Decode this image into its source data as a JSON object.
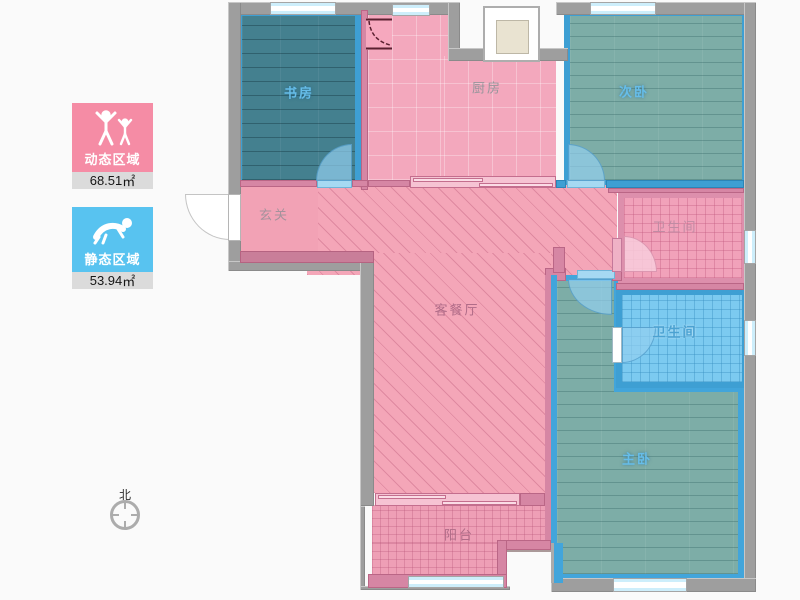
{
  "legend": {
    "dynamic": {
      "label": "动态区域",
      "value": "68.51",
      "unit": "㎡",
      "color": "#F58CA5"
    },
    "static": {
      "label": "静态区域",
      "value": "53.94",
      "unit": "㎡",
      "color": "#58C3F0"
    }
  },
  "compass": {
    "north_label": "北"
  },
  "rooms": {
    "study": {
      "label": "书房"
    },
    "kitchen": {
      "label": "厨房"
    },
    "second_bedroom": {
      "label": "次卧"
    },
    "hallway": {
      "label": "玄关"
    },
    "living_dining": {
      "label": "客餐厅"
    },
    "bathroom_1": {
      "label": "卫生间"
    },
    "bathroom_2": {
      "label": "卫生间"
    },
    "master_bedroom": {
      "label": "主卧"
    },
    "balcony": {
      "label": "阳台"
    }
  },
  "colors": {
    "dynamic_area": "#F58CA5",
    "static_area": "#58C3F0",
    "wall_gray": "#9E9E9E",
    "wall_pink": "#D686A4",
    "wall_blue": "#3E9FD3",
    "study_floor": "#44808F",
    "bedroom_floor": "#7DADA7",
    "bath_blue_floor": "#7CCAF0",
    "pink_floor": "#F3A8BD",
    "background": "#FAFAFA"
  }
}
